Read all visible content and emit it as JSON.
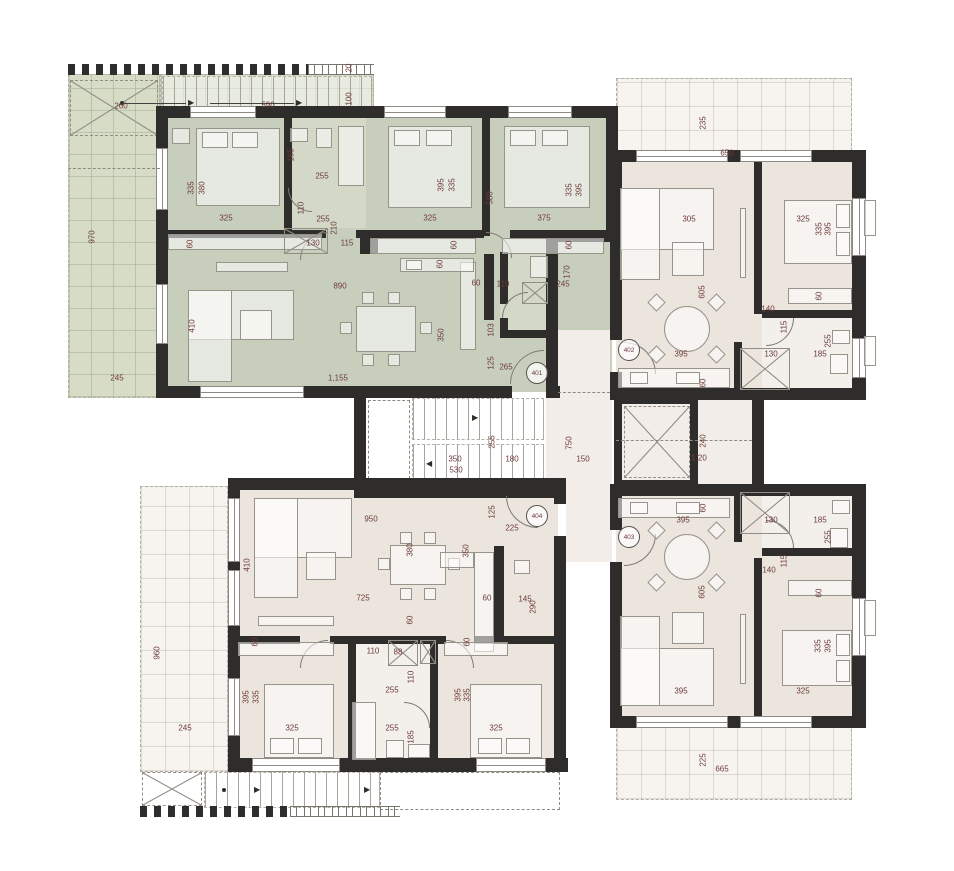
{
  "plan": {
    "type": "architectural-floor-plan",
    "description": "four apartment units around a stair and elevator core"
  },
  "colors": {
    "wall": "#2e2d2b",
    "apartment_401_floor": "#c8cebc",
    "apartment_401_bath": "#d3d8c7",
    "apartment_401_terrace": "#d6dcc6",
    "neutral_floor": "#ece5de",
    "neutral_bath": "#f3efeb",
    "core_floor": "#f2ede8",
    "terrace_floor": "#f7f4f0",
    "dimension_text": "#6d3a3a"
  },
  "unit_badges": [
    {
      "number": "401",
      "x": 537,
      "y": 373
    },
    {
      "number": "402",
      "x": 629,
      "y": 350
    },
    {
      "number": "403",
      "x": 629,
      "y": 537
    },
    {
      "number": "404",
      "x": 537,
      "y": 516
    }
  ],
  "areas": [
    {
      "name": "external-stair-top",
      "labels": [
        {
          "t": "260",
          "x": 121,
          "y": 106
        },
        {
          "t": "590",
          "x": 268,
          "y": 105
        },
        {
          "t": "100",
          "x": 349,
          "y": 99,
          "v": true
        },
        {
          "t": "20",
          "x": 349,
          "y": 68,
          "v": true
        }
      ]
    },
    {
      "name": "terrace-401",
      "labels": [
        {
          "t": "970",
          "x": 92,
          "y": 237,
          "v": true
        },
        {
          "t": "245",
          "x": 117,
          "y": 378
        }
      ]
    },
    {
      "name": "apartment-401",
      "labels": [
        {
          "t": "335",
          "x": 191,
          "y": 188,
          "v": true
        },
        {
          "t": "380",
          "x": 202,
          "y": 188,
          "v": true
        },
        {
          "t": "325",
          "x": 226,
          "y": 218
        },
        {
          "t": "60",
          "x": 190,
          "y": 244,
          "v": true
        },
        {
          "t": "165",
          "x": 291,
          "y": 155,
          "v": true
        },
        {
          "t": "255",
          "x": 322,
          "y": 176
        },
        {
          "t": "110",
          "x": 301,
          "y": 208,
          "v": true
        },
        {
          "t": "255",
          "x": 323,
          "y": 219
        },
        {
          "t": "210",
          "x": 334,
          "y": 228,
          "v": true
        },
        {
          "t": "130",
          "x": 313,
          "y": 243
        },
        {
          "t": "115",
          "x": 347,
          "y": 243
        },
        {
          "t": "890",
          "x": 340,
          "y": 286
        },
        {
          "t": "410",
          "x": 192,
          "y": 326,
          "v": true
        },
        {
          "t": "350",
          "x": 441,
          "y": 335,
          "v": true
        },
        {
          "t": "1,155",
          "x": 338,
          "y": 378
        },
        {
          "t": "395",
          "x": 441,
          "y": 185,
          "v": true
        },
        {
          "t": "335",
          "x": 452,
          "y": 185,
          "v": true
        },
        {
          "t": "325",
          "x": 430,
          "y": 218
        },
        {
          "t": "580",
          "x": 490,
          "y": 198,
          "v": true
        },
        {
          "t": "335",
          "x": 569,
          "y": 190,
          "v": true
        },
        {
          "t": "395",
          "x": 579,
          "y": 190,
          "v": true
        },
        {
          "t": "375",
          "x": 544,
          "y": 218
        },
        {
          "t": "60",
          "x": 454,
          "y": 245,
          "v": true
        },
        {
          "t": "60",
          "x": 569,
          "y": 245,
          "v": true
        },
        {
          "t": "60",
          "x": 440,
          "y": 264,
          "v": true
        },
        {
          "t": "60",
          "x": 476,
          "y": 283
        },
        {
          "t": "110",
          "x": 503,
          "y": 284
        },
        {
          "t": "170",
          "x": 567,
          "y": 272,
          "v": true
        },
        {
          "t": "245",
          "x": 563,
          "y": 284
        },
        {
          "t": "103",
          "x": 491,
          "y": 330,
          "v": true
        },
        {
          "t": "125",
          "x": 491,
          "y": 363,
          "v": true
        },
        {
          "t": "265",
          "x": 506,
          "y": 367
        }
      ]
    },
    {
      "name": "apartment-402",
      "labels": [
        {
          "t": "235",
          "x": 703,
          "y": 123,
          "v": true
        },
        {
          "t": "650",
          "x": 727,
          "y": 153
        },
        {
          "t": "305",
          "x": 689,
          "y": 219
        },
        {
          "t": "605",
          "x": 702,
          "y": 292,
          "v": true
        },
        {
          "t": "395",
          "x": 681,
          "y": 354
        },
        {
          "t": "60",
          "x": 703,
          "y": 383,
          "v": true
        },
        {
          "t": "325",
          "x": 803,
          "y": 219
        },
        {
          "t": "335",
          "x": 819,
          "y": 229,
          "v": true
        },
        {
          "t": "395",
          "x": 828,
          "y": 229,
          "v": true
        },
        {
          "t": "60",
          "x": 819,
          "y": 296,
          "v": true
        },
        {
          "t": "140",
          "x": 768,
          "y": 309
        },
        {
          "t": "115",
          "x": 784,
          "y": 327,
          "v": true
        },
        {
          "t": "130",
          "x": 771,
          "y": 354
        },
        {
          "t": "185",
          "x": 820,
          "y": 354
        },
        {
          "t": "255",
          "x": 828,
          "y": 341,
          "v": true
        }
      ]
    },
    {
      "name": "core",
      "labels": [
        {
          "t": "255",
          "x": 492,
          "y": 442,
          "v": true
        },
        {
          "t": "350",
          "x": 455,
          "y": 459
        },
        {
          "t": "530",
          "x": 456,
          "y": 470
        },
        {
          "t": "180",
          "x": 512,
          "y": 459
        },
        {
          "t": "750",
          "x": 569,
          "y": 443,
          "v": true
        },
        {
          "t": "150",
          "x": 583,
          "y": 459
        },
        {
          "t": "240",
          "x": 703,
          "y": 441,
          "v": true
        },
        {
          "t": "1.20",
          "x": 699,
          "y": 458
        }
      ]
    },
    {
      "name": "apartment-403",
      "labels": [
        {
          "t": "60",
          "x": 703,
          "y": 508,
          "v": true
        },
        {
          "t": "395",
          "x": 683,
          "y": 520
        },
        {
          "t": "130",
          "x": 771,
          "y": 520
        },
        {
          "t": "185",
          "x": 820,
          "y": 520
        },
        {
          "t": "255",
          "x": 828,
          "y": 537,
          "v": true
        },
        {
          "t": "115",
          "x": 784,
          "y": 561,
          "v": true
        },
        {
          "t": "140",
          "x": 769,
          "y": 570
        },
        {
          "t": "605",
          "x": 702,
          "y": 592,
          "v": true
        },
        {
          "t": "60",
          "x": 819,
          "y": 593,
          "v": true
        },
        {
          "t": "335",
          "x": 818,
          "y": 646,
          "v": true
        },
        {
          "t": "395",
          "x": 828,
          "y": 646,
          "v": true
        },
        {
          "t": "395",
          "x": 681,
          "y": 691
        },
        {
          "t": "325",
          "x": 803,
          "y": 691
        },
        {
          "t": "225",
          "x": 703,
          "y": 760,
          "v": true
        },
        {
          "t": "665",
          "x": 722,
          "y": 769
        }
      ]
    },
    {
      "name": "apartment-404",
      "labels": [
        {
          "t": "950",
          "x": 371,
          "y": 519
        },
        {
          "t": "125",
          "x": 492,
          "y": 512,
          "v": true
        },
        {
          "t": "225",
          "x": 512,
          "y": 528
        },
        {
          "t": "410",
          "x": 247,
          "y": 565,
          "v": true
        },
        {
          "t": "380",
          "x": 410,
          "y": 550,
          "v": true
        },
        {
          "t": "350",
          "x": 466,
          "y": 551,
          "v": true
        },
        {
          "t": "725",
          "x": 363,
          "y": 598
        },
        {
          "t": "60",
          "x": 487,
          "y": 598
        },
        {
          "t": "145",
          "x": 525,
          "y": 599
        },
        {
          "t": "290",
          "x": 533,
          "y": 607,
          "v": true
        },
        {
          "t": "60",
          "x": 410,
          "y": 620,
          "v": true
        },
        {
          "t": "60",
          "x": 467,
          "y": 642,
          "v": true
        },
        {
          "t": "110",
          "x": 373,
          "y": 651
        },
        {
          "t": "88",
          "x": 398,
          "y": 652
        },
        {
          "t": "60",
          "x": 255,
          "y": 642,
          "v": true
        },
        {
          "t": "110",
          "x": 411,
          "y": 677,
          "v": true
        },
        {
          "t": "255",
          "x": 392,
          "y": 690
        },
        {
          "t": "395",
          "x": 246,
          "y": 697,
          "v": true
        },
        {
          "t": "335",
          "x": 256,
          "y": 697,
          "v": true
        },
        {
          "t": "325",
          "x": 292,
          "y": 728
        },
        {
          "t": "255",
          "x": 392,
          "y": 728
        },
        {
          "t": "185",
          "x": 411,
          "y": 737,
          "v": true
        },
        {
          "t": "395",
          "x": 458,
          "y": 695,
          "v": true
        },
        {
          "t": "335",
          "x": 467,
          "y": 695,
          "v": true
        },
        {
          "t": "325",
          "x": 496,
          "y": 728
        },
        {
          "t": "960",
          "x": 157,
          "y": 653,
          "v": true
        },
        {
          "t": "245",
          "x": 185,
          "y": 728
        }
      ]
    }
  ]
}
